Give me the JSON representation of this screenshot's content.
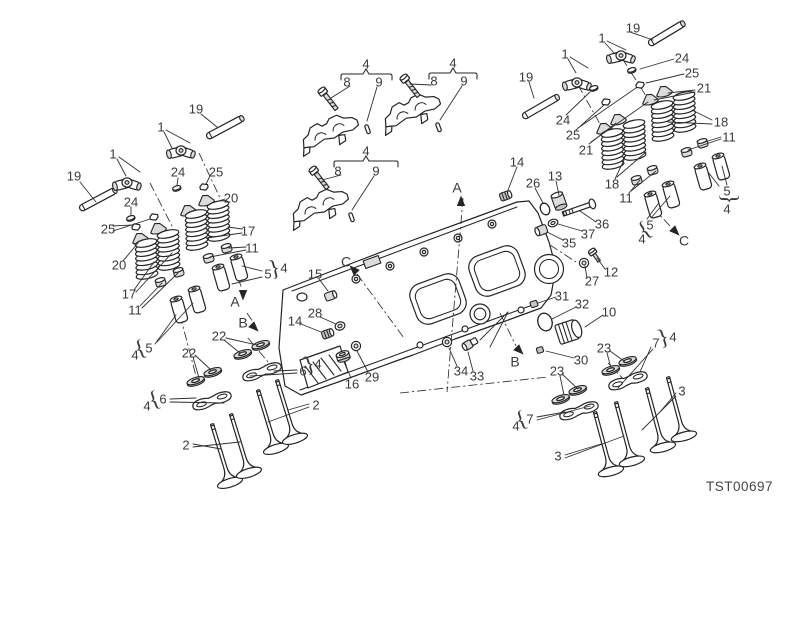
{
  "figure": {
    "code": "TST00697"
  },
  "colors": {
    "line": "#242424",
    "label": "#3a3a3a",
    "background": "#ffffff",
    "shade": "#dcdcdc"
  },
  "part_labels": [
    {
      "text": "19",
      "x": 74,
      "y": 176
    },
    {
      "text": "1",
      "x": 113,
      "y": 154
    },
    {
      "text": "1",
      "x": 161,
      "y": 127
    },
    {
      "text": "19",
      "x": 196,
      "y": 109
    },
    {
      "text": "24",
      "x": 178,
      "y": 172
    },
    {
      "text": "25",
      "x": 216,
      "y": 172
    },
    {
      "text": "20",
      "x": 231,
      "y": 198
    },
    {
      "text": "24",
      "x": 131,
      "y": 202
    },
    {
      "text": "25",
      "x": 108,
      "y": 229
    },
    {
      "text": "17",
      "x": 248,
      "y": 231
    },
    {
      "text": "11",
      "x": 252,
      "y": 248
    },
    {
      "text": "20",
      "x": 119,
      "y": 265
    },
    {
      "text": "17",
      "x": 129,
      "y": 294
    },
    {
      "text": "11",
      "x": 135,
      "y": 310
    },
    {
      "text": "5",
      "x": 268,
      "y": 274
    },
    {
      "text": "4",
      "x": 284,
      "y": 268
    },
    {
      "text": "5",
      "x": 149,
      "y": 348
    },
    {
      "text": "4",
      "x": 135,
      "y": 355
    },
    {
      "text": "4",
      "x": 366,
      "y": 64
    },
    {
      "text": "8",
      "x": 347,
      "y": 82
    },
    {
      "text": "9",
      "x": 379,
      "y": 82
    },
    {
      "text": "4",
      "x": 453,
      "y": 63
    },
    {
      "text": "8",
      "x": 434,
      "y": 81
    },
    {
      "text": "9",
      "x": 464,
      "y": 81
    },
    {
      "text": "4",
      "x": 366,
      "y": 151
    },
    {
      "text": "8",
      "x": 338,
      "y": 171
    },
    {
      "text": "9",
      "x": 376,
      "y": 171
    },
    {
      "text": "19",
      "x": 633,
      "y": 28
    },
    {
      "text": "1",
      "x": 602,
      "y": 38
    },
    {
      "text": "1",
      "x": 565,
      "y": 54
    },
    {
      "text": "19",
      "x": 526,
      "y": 77
    },
    {
      "text": "24",
      "x": 682,
      "y": 58
    },
    {
      "text": "25",
      "x": 692,
      "y": 73
    },
    {
      "text": "21",
      "x": 704,
      "y": 88
    },
    {
      "text": "18",
      "x": 721,
      "y": 122
    },
    {
      "text": "11",
      "x": 729,
      "y": 137
    },
    {
      "text": "24",
      "x": 563,
      "y": 120
    },
    {
      "text": "25",
      "x": 573,
      "y": 135
    },
    {
      "text": "21",
      "x": 586,
      "y": 150
    },
    {
      "text": "18",
      "x": 612,
      "y": 184
    },
    {
      "text": "11",
      "x": 626,
      "y": 198
    },
    {
      "text": "5",
      "x": 727,
      "y": 191
    },
    {
      "text": "4",
      "x": 727,
      "y": 209
    },
    {
      "text": "5",
      "x": 650,
      "y": 225
    },
    {
      "text": "4",
      "x": 642,
      "y": 239
    },
    {
      "text": "14",
      "x": 517,
      "y": 162
    },
    {
      "text": "26",
      "x": 533,
      "y": 183
    },
    {
      "text": "13",
      "x": 555,
      "y": 176
    },
    {
      "text": "36",
      "x": 602,
      "y": 224
    },
    {
      "text": "37",
      "x": 588,
      "y": 234
    },
    {
      "text": "35",
      "x": 569,
      "y": 243
    },
    {
      "text": "12",
      "x": 611,
      "y": 272
    },
    {
      "text": "27",
      "x": 592,
      "y": 281
    },
    {
      "text": "31",
      "x": 562,
      "y": 296
    },
    {
      "text": "32",
      "x": 582,
      "y": 304
    },
    {
      "text": "10",
      "x": 609,
      "y": 312
    },
    {
      "text": "30",
      "x": 581,
      "y": 360
    },
    {
      "text": "33",
      "x": 477,
      "y": 376
    },
    {
      "text": "34",
      "x": 461,
      "y": 371
    },
    {
      "text": "15",
      "x": 315,
      "y": 274
    },
    {
      "text": "28",
      "x": 315,
      "y": 313
    },
    {
      "text": "14",
      "x": 295,
      "y": 321
    },
    {
      "text": "16",
      "x": 352,
      "y": 384
    },
    {
      "text": "29",
      "x": 372,
      "y": 377
    },
    {
      "text": "22",
      "x": 219,
      "y": 336
    },
    {
      "text": "22",
      "x": 189,
      "y": 353
    },
    {
      "text": "6",
      "x": 303,
      "y": 371
    },
    {
      "text": "4",
      "x": 318,
      "y": 364
    },
    {
      "text": "6",
      "x": 163,
      "y": 399
    },
    {
      "text": "4",
      "x": 147,
      "y": 406
    },
    {
      "text": "2",
      "x": 316,
      "y": 405
    },
    {
      "text": "2",
      "x": 186,
      "y": 445
    },
    {
      "text": "23",
      "x": 604,
      "y": 348
    },
    {
      "text": "7",
      "x": 656,
      "y": 343
    },
    {
      "text": "4",
      "x": 673,
      "y": 337
    },
    {
      "text": "23",
      "x": 557,
      "y": 371
    },
    {
      "text": "7",
      "x": 530,
      "y": 419
    },
    {
      "text": "4",
      "x": 516,
      "y": 426
    },
    {
      "text": "3",
      "x": 682,
      "y": 391
    },
    {
      "text": "3",
      "x": 558,
      "y": 456
    }
  ],
  "section_markers": [
    {
      "letter": "A",
      "x": 457,
      "y": 188
    },
    {
      "letter": "A",
      "x": 235,
      "y": 302
    },
    {
      "letter": "B",
      "x": 243,
      "y": 323
    },
    {
      "letter": "B",
      "x": 515,
      "y": 362
    },
    {
      "letter": "C",
      "x": 346,
      "y": 262
    },
    {
      "letter": "C",
      "x": 684,
      "y": 241
    }
  ],
  "braces": [
    {
      "glyph": "}",
      "x": 275,
      "y": 271,
      "rot": -15
    },
    {
      "glyph": "{",
      "x": 141,
      "y": 351,
      "rot": -20
    },
    {
      "glyph": "}",
      "x": 310,
      "y": 367,
      "rot": -18
    },
    {
      "glyph": "{",
      "x": 155,
      "y": 402,
      "rot": -20
    },
    {
      "glyph": "}",
      "x": 664,
      "y": 340,
      "rot": -18
    },
    {
      "glyph": "{",
      "x": 522,
      "y": 422,
      "rot": -20
    },
    {
      "glyph": "}",
      "x": 727,
      "y": 199,
      "rot": 90
    },
    {
      "glyph": "{",
      "x": 646,
      "y": 232,
      "rot": -35
    }
  ]
}
